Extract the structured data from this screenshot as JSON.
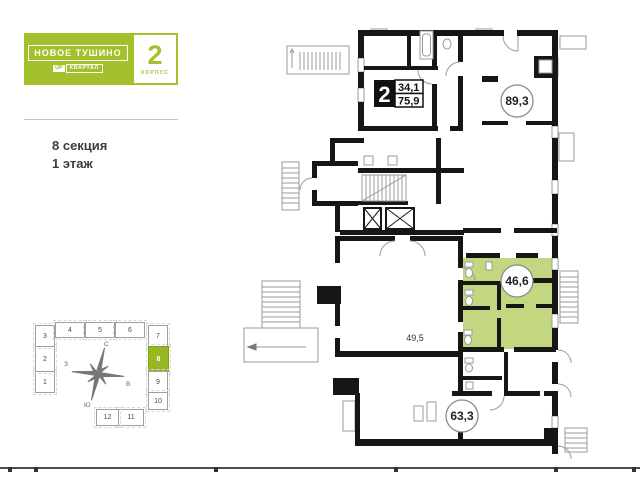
{
  "header": {
    "project_name": "НОВОЕ ТУШИНО",
    "brand_badge_prefix": "UP",
    "brand_badge_suffix": "КВАРТАЛ",
    "korpus_number": "2",
    "korpus_label": "КОРПУС"
  },
  "location": {
    "section_label": "8 секция",
    "floor_label": "1 этаж"
  },
  "floor_plan": {
    "apartment_badge": {
      "rooms": "2",
      "area_living": "34,1",
      "area_total": "75,9"
    },
    "units": [
      {
        "area": "89,3",
        "highlighted": false
      },
      {
        "area": "46,6",
        "highlighted": true
      },
      {
        "area": "63,3",
        "highlighted": false
      }
    ],
    "room_label": "49,5",
    "colors": {
      "highlight_fill": "#c3d781",
      "wall": "#161616",
      "thin_line": "#9b9b9b"
    }
  },
  "section_map": {
    "active_section": "8",
    "sections": [
      {
        "n": "1"
      },
      {
        "n": "2"
      },
      {
        "n": "3"
      },
      {
        "n": "4"
      },
      {
        "n": "5"
      },
      {
        "n": "6"
      },
      {
        "n": "7"
      },
      {
        "n": "8"
      },
      {
        "n": "9"
      },
      {
        "n": "10"
      },
      {
        "n": "11"
      },
      {
        "n": "12"
      }
    ],
    "compass": {
      "north": "С",
      "south": "Ю",
      "west": "З",
      "east": "В"
    }
  },
  "colors": {
    "brand_green": "#a3c12c",
    "section_active_green": "#97b822"
  }
}
